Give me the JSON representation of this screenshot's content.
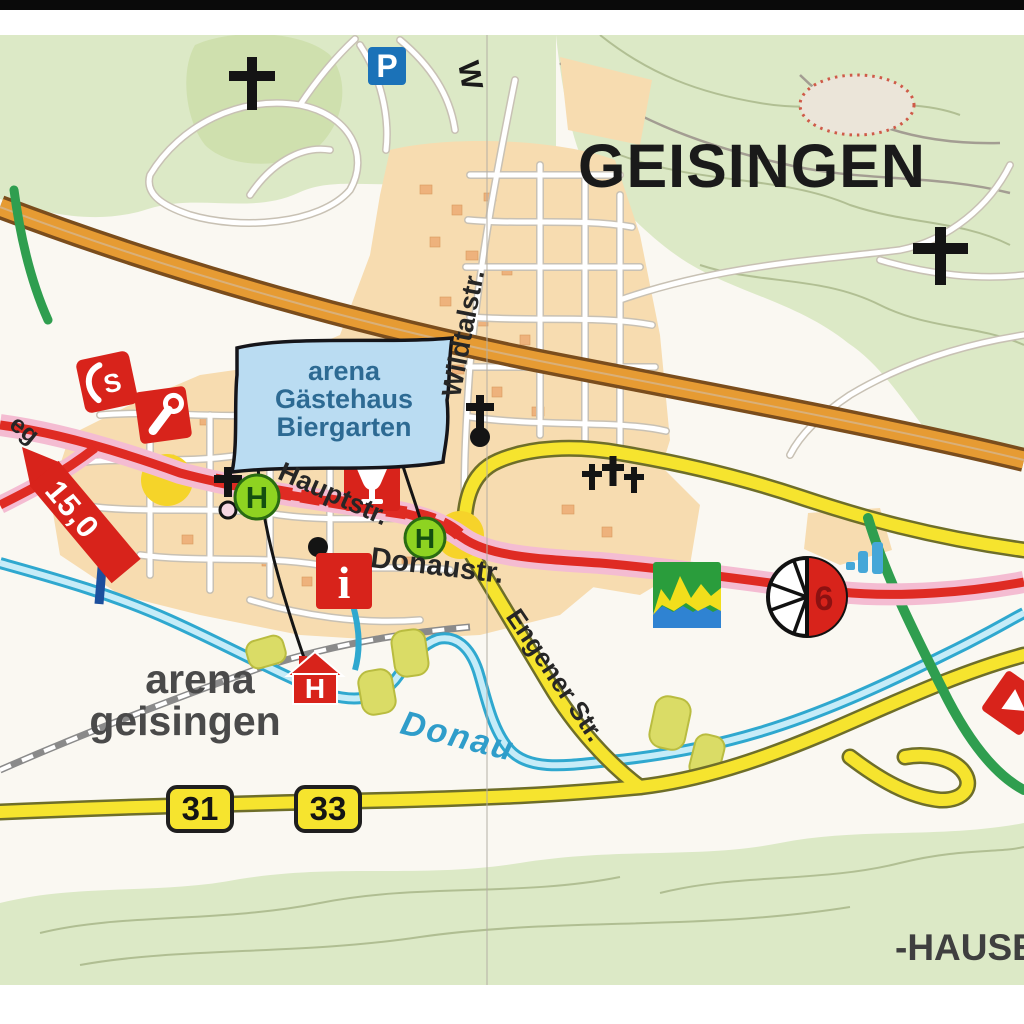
{
  "map": {
    "town_title": "GEISINGEN",
    "neighbor_label_partial": "-HAUSE",
    "banner": {
      "line1": "arena",
      "line2": "Gästehaus",
      "line3": "Biergarten"
    },
    "arena_label": {
      "line1": "arena",
      "line2": "geisingen"
    },
    "streets": {
      "wildtal": "Wildtalstr.",
      "haupt": "Hauptstr.",
      "donau": "Donaustr.",
      "engener": "Engener Str.",
      "weg_partial": "eg",
      "w_partial": "W"
    },
    "river": {
      "donau": "Donau"
    },
    "distance_marker_km": "15,0",
    "road_badges": {
      "b31": "31",
      "b33": "33"
    },
    "cycle_route_number": "6",
    "icons": {
      "parking": "P",
      "bus_stop": "H",
      "hotel": "H",
      "info": "i",
      "lift": "S"
    },
    "colors": {
      "forest_green": "#dce9c6",
      "urban_peach": "#f7dcb0",
      "highway_orange": "#e69b33",
      "road_yellow": "#f6e42e",
      "route_red": "#df2b23",
      "route_halo_pink": "#f4bcd2",
      "route_green": "#2f9e4f",
      "river_blue": "#2fa8cf",
      "poi_red": "#d8231b",
      "bus_green": "#8ed321",
      "parking_blue": "#1b72b8",
      "banner_blue": "#badcf2"
    }
  }
}
